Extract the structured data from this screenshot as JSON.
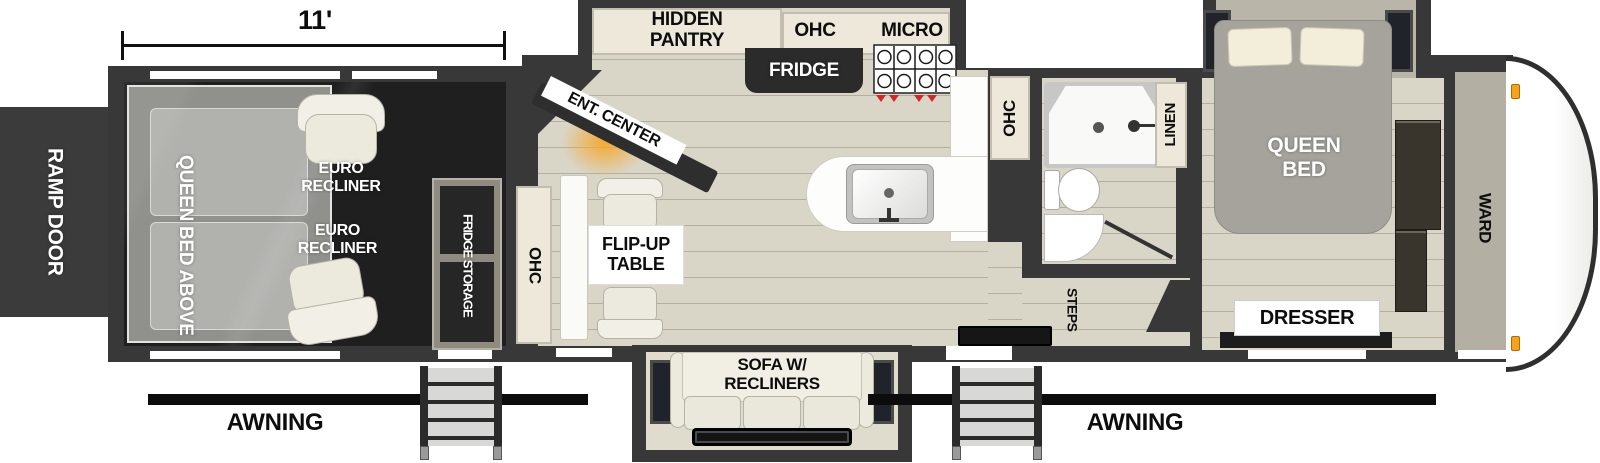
{
  "floorplan": {
    "title_dimension": "11'",
    "ramp_door_label": "RAMP DOOR",
    "awning_left": "AWNING",
    "awning_right": "AWNING",
    "garage": {
      "queen_bed_above": "QUEEN BED ABOVE",
      "euro_recliner_1": "EURO RECLINER",
      "euro_recliner_2": "EURO RECLINER",
      "fridge_storage": "FRIDGE STORAGE"
    },
    "living": {
      "ohc_left": "OHC",
      "flip_up_table": "FLIP-UP TABLE",
      "ent_center": "ENT. CENTER",
      "sofa_recliners": "SOFA W/ RECLINERS"
    },
    "kitchen": {
      "hidden_pantry": "HIDDEN PANTRY",
      "ohc": "OHC",
      "micro": "MICRO",
      "fridge": "FRIDGE",
      "ohc_right": "OHC"
    },
    "bath": {
      "linen": "LINEN",
      "steps": "STEPS"
    },
    "bedroom": {
      "queen_bed": "QUEEN BED",
      "dresser": "DRESSER",
      "ward": "WARD"
    },
    "colors": {
      "wall": "#383838",
      "floor": "#d9d5c7",
      "cabinet_cream": "#ede8d9",
      "dark_interior": "#1f1f1f",
      "fireplace_glow": "#f5a33c",
      "marker_light_orange": "#f6a21c",
      "burner_red": "#d22727"
    }
  }
}
